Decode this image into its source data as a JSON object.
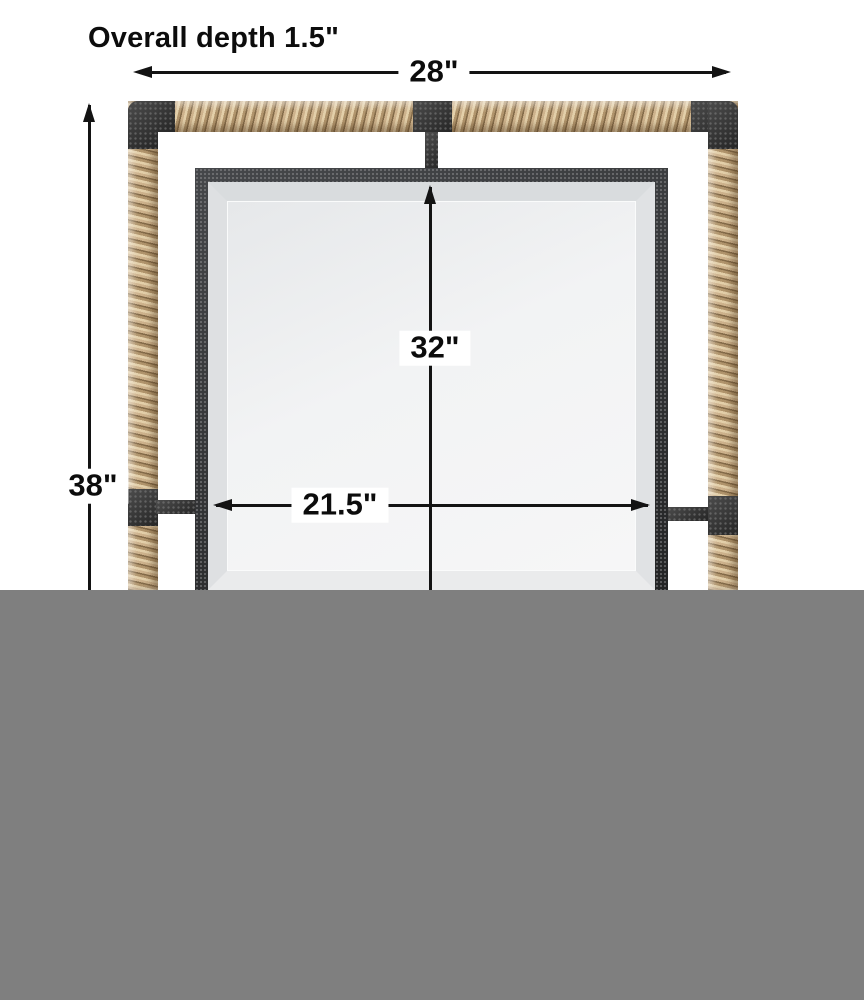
{
  "diagram": {
    "subject": "rope-wrapped framed mirror dimension diagram",
    "title": "Overall depth 1.5\"",
    "overall_width_label": "28\"",
    "overall_height_label": "38\"",
    "mirror_height_label": "32\"",
    "mirror_width_label": "21.5\"",
    "colors": {
      "background": "#ffffff",
      "dimension_line": "#131313",
      "rope": "#c9ae88",
      "rope_shadow": "#8d7454",
      "metal_frame": "#353535",
      "mirror_bevel": "#dde0e2",
      "mirror_glass": "#f2f3f4",
      "crop_gray": "#7f7f7f"
    }
  }
}
